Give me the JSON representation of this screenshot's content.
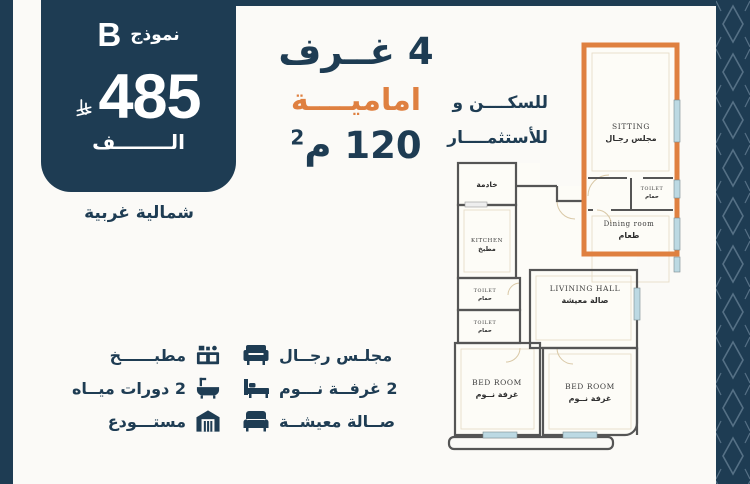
{
  "theme": {
    "navy": "#1e3c53",
    "orange": "#df8040",
    "page_bg": "#fbfaf7",
    "wall": "#555555",
    "window_blue": "#bcd9e3"
  },
  "badge": {
    "model_label": "نموذج",
    "model_letter": "B",
    "price": "485",
    "currency_icon": "riyal-icon",
    "thousand_label": "الــــــــف"
  },
  "orientation_label": "شمالية غربية",
  "headline": {
    "rooms": "4 غــرف",
    "front": "اماميــــة",
    "area_main": "120 م",
    "area_sup": "2"
  },
  "tagline": {
    "line1": "للسكــــن و",
    "line2": "للأستثمــــار"
  },
  "floor_plan": {
    "rooms": [
      {
        "id": "sitting",
        "en": "SITTING",
        "ar": "مجلس رجـال"
      },
      {
        "id": "toilet-a",
        "en": "TOILET",
        "ar": "حمام"
      },
      {
        "id": "dining",
        "en": "Dining  room",
        "ar": "طعام"
      },
      {
        "id": "maid",
        "en": "",
        "ar": "خادمة"
      },
      {
        "id": "kitchen",
        "en": "KITCHEN",
        "ar": "مطبخ"
      },
      {
        "id": "toilet-b",
        "en": "TOILET",
        "ar": "حمام"
      },
      {
        "id": "toilet-c",
        "en": "TOILET",
        "ar": "حمام"
      },
      {
        "id": "living-hall",
        "en": "LIVINING  HALL",
        "ar": "صالة معيشة"
      },
      {
        "id": "bedroom-1",
        "en": "BED  ROOM",
        "ar": "غرفة نــوم"
      },
      {
        "id": "bedroom-2",
        "en": "BED  ROOM",
        "ar": "غرفة نــوم"
      }
    ]
  },
  "legend": {
    "left": [
      {
        "label": "مطبــــــخ",
        "icon": "kitchen-icon"
      },
      {
        "label": "2 دورات ميــاه",
        "icon": "bathtub-icon"
      },
      {
        "label": "مستـــودع",
        "icon": "warehouse-icon"
      }
    ],
    "right": [
      {
        "label": "مجلـس رجــال",
        "icon": "sofa-icon"
      },
      {
        "label": "2 غرفــة نـــوم",
        "icon": "bed-icon"
      },
      {
        "label": "صــالة معيشــة",
        "icon": "couch-icon"
      }
    ]
  }
}
